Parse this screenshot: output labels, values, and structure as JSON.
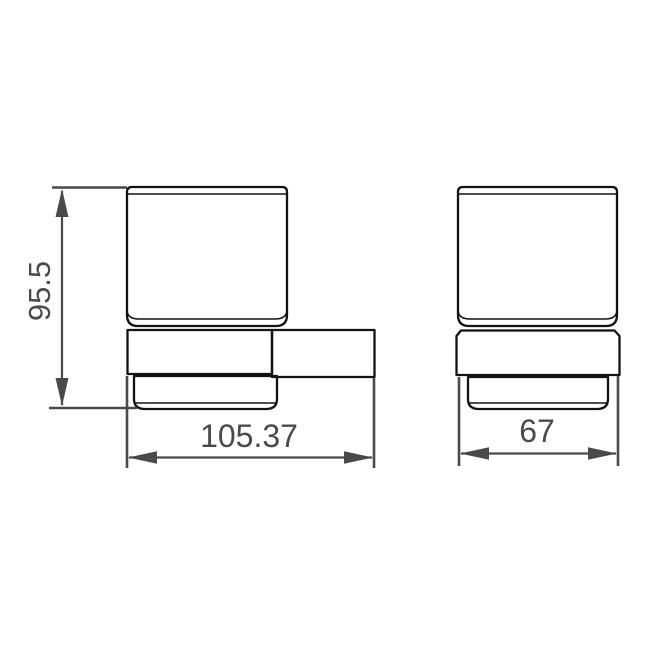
{
  "drawing": {
    "kind": "technical-dimension-drawing",
    "subject": "wall-mounted glass tumbler holder",
    "colors": {
      "background": "#ffffff",
      "outline": "#121212",
      "dimension": "#4a4a4a"
    },
    "views": {
      "front": {
        "name": "front view with wall bracket",
        "dimensions": {
          "height": {
            "label": "95.5",
            "orientation": "vertical"
          },
          "width": {
            "label": "105.37",
            "orientation": "horizontal"
          }
        }
      },
      "side": {
        "name": "side view",
        "dimensions": {
          "width": {
            "label": "67",
            "orientation": "horizontal"
          }
        }
      }
    }
  }
}
